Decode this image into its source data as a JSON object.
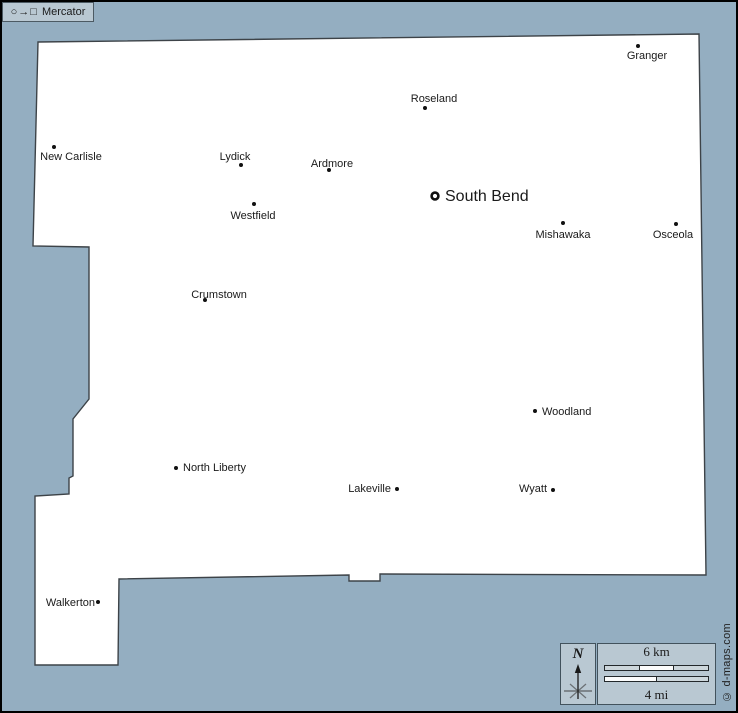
{
  "map": {
    "colors": {
      "water": "#94aec1",
      "land": "#ffffff",
      "boundary": "#3d4348",
      "frame": "#000000",
      "panel": "#b9c8d2",
      "marker": "#111111",
      "label_text": "#1a1a1a",
      "scale_segment_light": "#ccd6db",
      "scale_segment_white": "#fbfcfc"
    },
    "county_outline": [
      [
        36,
        40
      ],
      [
        697,
        32
      ],
      [
        704,
        573
      ],
      [
        378,
        572
      ],
      [
        378,
        579
      ],
      [
        347,
        579
      ],
      [
        347,
        573
      ],
      [
        117,
        577
      ],
      [
        116,
        663
      ],
      [
        33,
        663
      ],
      [
        33,
        494
      ],
      [
        67,
        492
      ],
      [
        67,
        476
      ],
      [
        71,
        474
      ],
      [
        71,
        417
      ],
      [
        87,
        397
      ],
      [
        87,
        245
      ],
      [
        31,
        244
      ]
    ],
    "cities": [
      {
        "name": "Granger",
        "marker": "dot",
        "dot": [
          636,
          44
        ],
        "label": [
          645,
          57
        ],
        "anchor": "middle",
        "size": 11
      },
      {
        "name": "Roseland",
        "marker": "dot",
        "dot": [
          423,
          106
        ],
        "label": [
          432,
          100
        ],
        "anchor": "middle",
        "size": 11
      },
      {
        "name": "New Carlisle",
        "marker": "dot",
        "dot": [
          52,
          145
        ],
        "label": [
          69,
          158
        ],
        "anchor": "middle",
        "size": 11
      },
      {
        "name": "Lydick",
        "marker": "dot",
        "dot": [
          239,
          163
        ],
        "label": [
          233,
          158
        ],
        "anchor": "middle",
        "size": 11
      },
      {
        "name": "Ardmore",
        "marker": "dot",
        "dot": [
          327,
          168
        ],
        "label": [
          330,
          165
        ],
        "anchor": "middle",
        "size": 11
      },
      {
        "name": "South Bend",
        "marker": "ring",
        "dot": [
          433,
          194
        ],
        "label": [
          443,
          199
        ],
        "anchor": "start",
        "size": 16
      },
      {
        "name": "Westfield",
        "marker": "dot",
        "dot": [
          252,
          202
        ],
        "label": [
          251,
          217
        ],
        "anchor": "middle",
        "size": 11
      },
      {
        "name": "Mishawaka",
        "marker": "dot",
        "dot": [
          561,
          221
        ],
        "label": [
          561,
          236
        ],
        "anchor": "middle",
        "size": 11
      },
      {
        "name": "Osceola",
        "marker": "dot",
        "dot": [
          674,
          222
        ],
        "label": [
          671,
          236
        ],
        "anchor": "middle",
        "size": 11
      },
      {
        "name": "Crumstown",
        "marker": "dot",
        "dot": [
          203,
          298
        ],
        "label": [
          217,
          296
        ],
        "anchor": "middle",
        "size": 11
      },
      {
        "name": "Woodland",
        "marker": "dot",
        "dot": [
          533,
          409
        ],
        "label": [
          540,
          413
        ],
        "anchor": "start",
        "size": 11
      },
      {
        "name": "North Liberty",
        "marker": "dot",
        "dot": [
          174,
          466
        ],
        "label": [
          181,
          469
        ],
        "anchor": "start",
        "size": 11
      },
      {
        "name": "Lakeville",
        "marker": "dot",
        "dot": [
          395,
          487
        ],
        "label": [
          389,
          490
        ],
        "anchor": "end",
        "size": 11
      },
      {
        "name": "Wyatt",
        "marker": "dot",
        "dot": [
          551,
          488
        ],
        "label": [
          545,
          490
        ],
        "anchor": "end",
        "size": 11
      },
      {
        "name": "Walkerton",
        "marker": "dot",
        "dot": [
          96,
          600
        ],
        "label": [
          93,
          604
        ],
        "anchor": "end",
        "size": 11
      }
    ]
  },
  "compass": {
    "north_label": "N"
  },
  "scale_bar": {
    "km_label": "6 km",
    "mi_label": "4 mi",
    "km_segments": [
      "light",
      "white",
      "light"
    ],
    "mi_segments": [
      "white",
      "light"
    ]
  },
  "projection": {
    "circle_glyph": "○",
    "arrow_glyph": "→",
    "square_glyph": "□",
    "label": "Mercator"
  },
  "credit": "© d-maps.com"
}
